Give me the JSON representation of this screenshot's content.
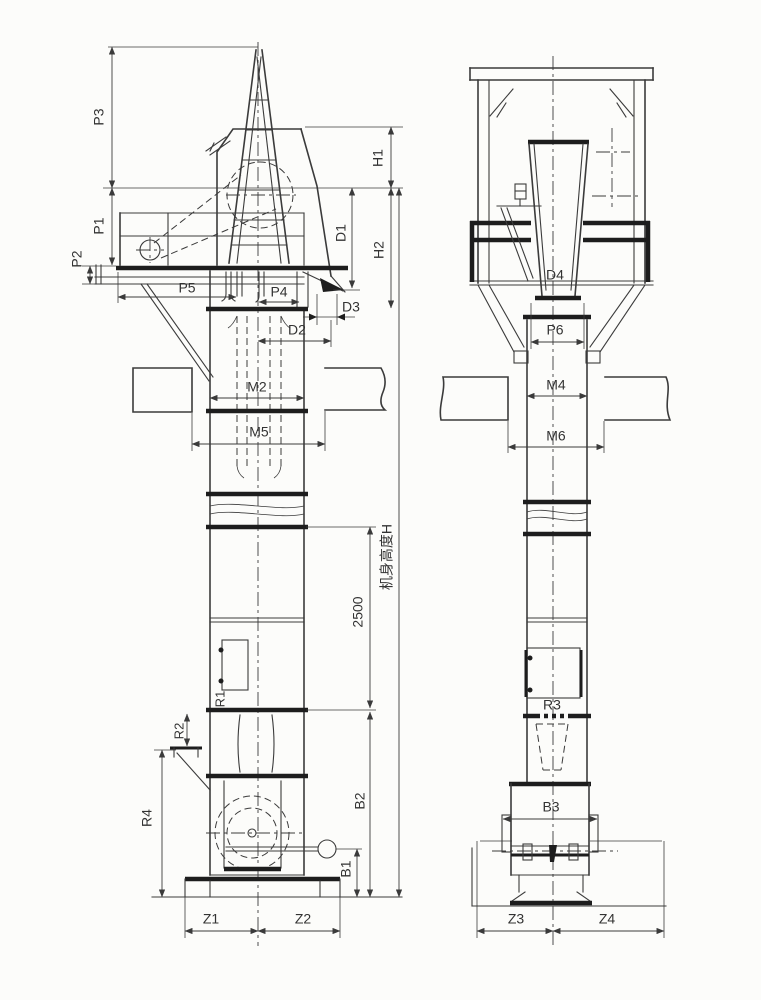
{
  "labels": {
    "p1": "P1",
    "p2": "P2",
    "p3": "P3",
    "p4": "P4",
    "p5": "P5",
    "p6": "P6",
    "h1": "H1",
    "h2": "H2",
    "d1": "D1",
    "d2": "D2",
    "d3": "D3",
    "d4": "D4",
    "m2": "M2",
    "m4": "M4",
    "m5": "M5",
    "m6": "M6",
    "r1": "R1",
    "r2": "R2",
    "r3": "R3",
    "r4": "R4",
    "b1": "B1",
    "b2": "B2",
    "b3": "B3",
    "z1": "Z1",
    "z2": "Z2",
    "z3": "Z3",
    "z4": "Z4",
    "dim_2500": "2500",
    "body_height": "机身高度H"
  },
  "colors": {
    "line": "#3b3b3b",
    "thick_line": "#1d1d1d",
    "background": "#fcfcfa",
    "label": "#333333"
  }
}
